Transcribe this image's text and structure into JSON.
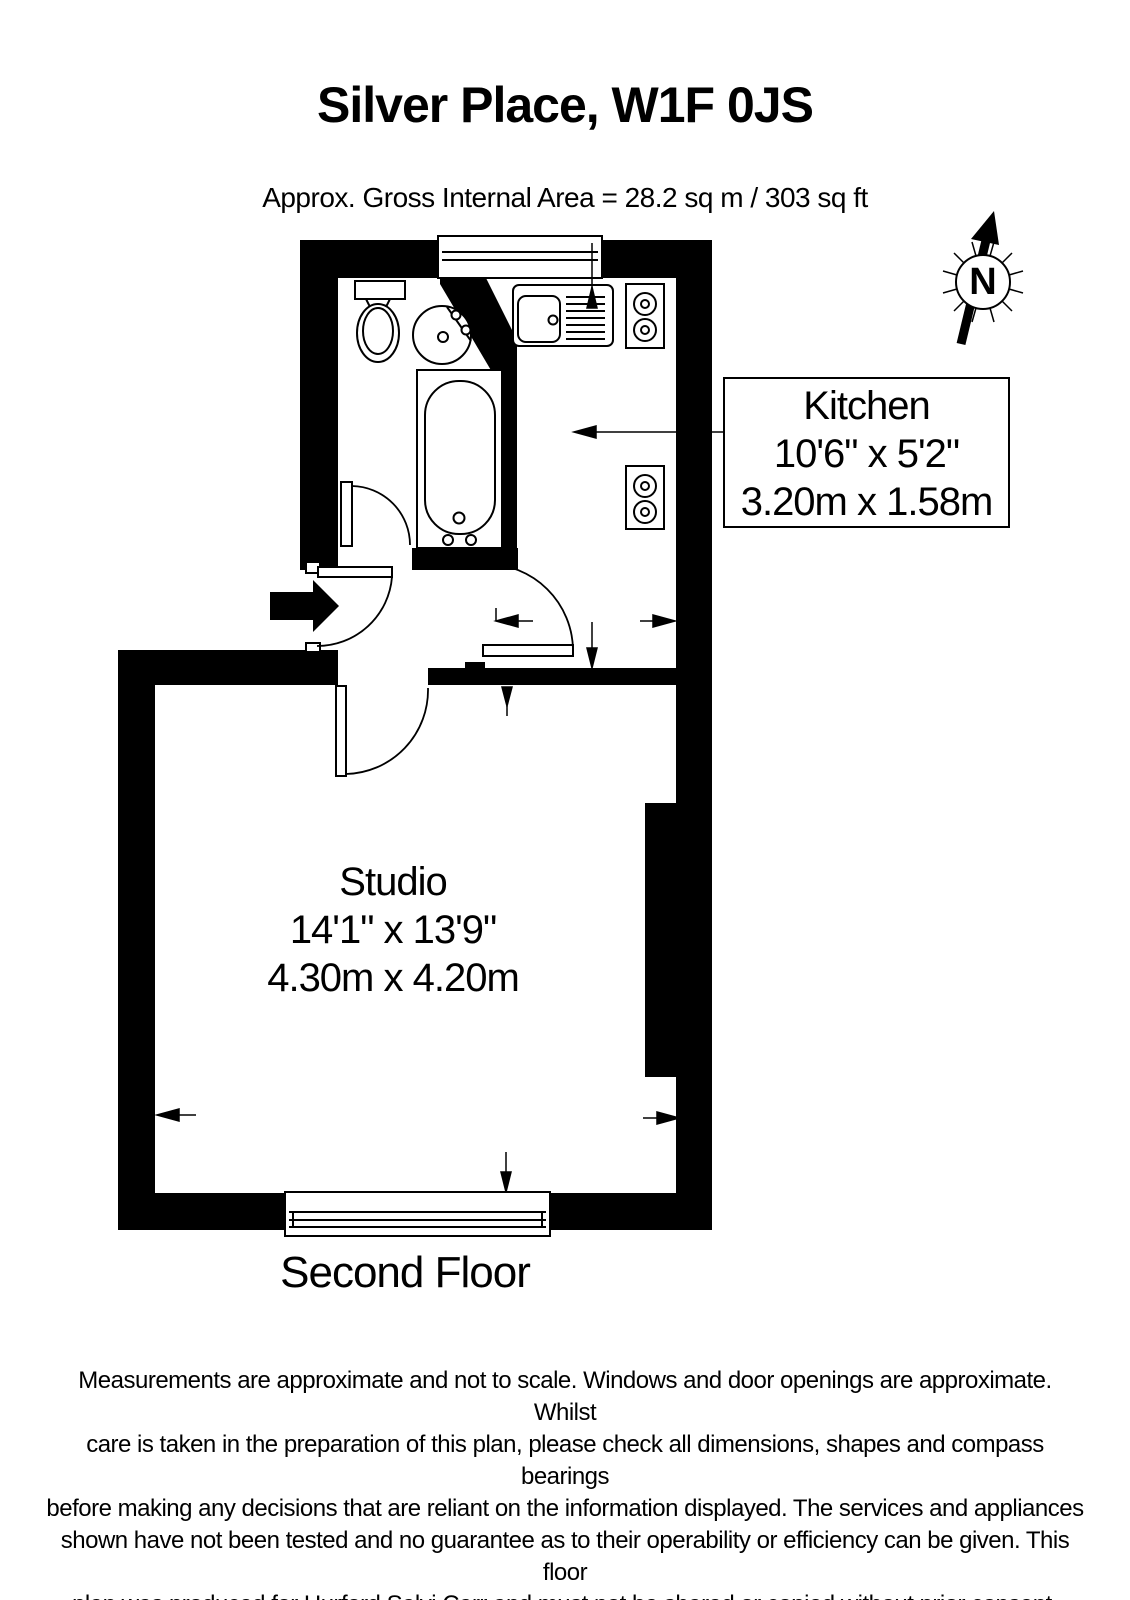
{
  "header": {
    "title": "Silver Place, W1F 0JS",
    "subtitle": "Approx. Gross Internal Area = 28.2 sq m / 303 sq ft"
  },
  "rooms": [
    {
      "name": "Kitchen",
      "imperial": "10'6\" x 5'2\"",
      "metric": "3.20m x 1.58m"
    },
    {
      "name": "Studio",
      "imperial": "14'1\" x 13'9\"",
      "metric": "4.30m x 4.20m"
    }
  ],
  "floor_label": "Second Floor",
  "compass": {
    "n": "N"
  },
  "colors": {
    "wall": "#000000",
    "background": "#ffffff"
  },
  "icons": [
    "compass-north-icon",
    "entry-arrow-icon",
    "toilet-icon",
    "basin-icon",
    "bathtub-icon",
    "kitchen-sink-icon",
    "hob-icon",
    "appliance-icon",
    "window-icon",
    "door-swing-icon",
    "measurement-arrow-icon"
  ],
  "disclaimer_lines": [
    "Measurements are approximate and not to scale. Windows and door openings are approximate. Whilst",
    "care is taken in the preparation of this plan, please check all dimensions, shapes and compass bearings",
    "before making any decisions that are reliant on the information displayed. The services and appliances",
    "shown have not been tested and no guarantee as to their operability or efficiency can be given. This floor",
    "plan was produced for Hurford Salvi Carr and must not be shared or copied without prior consent."
  ]
}
